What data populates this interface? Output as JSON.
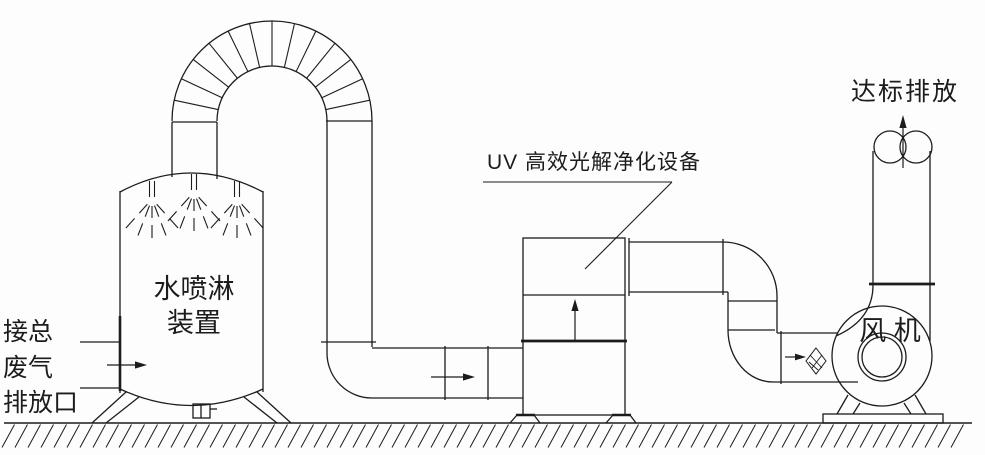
{
  "diagram": {
    "background": "#fdfdfd",
    "line_color": "#1c1c1c",
    "labels": {
      "inlet_line1": "接总",
      "inlet_line2": "废气",
      "inlet_line3": "排放口",
      "tower_line1": "水喷淋",
      "tower_line2": "装置",
      "uv_unit": "UV 高效光解净化设备",
      "fan": "风 机",
      "outlet": "达标排放"
    }
  }
}
